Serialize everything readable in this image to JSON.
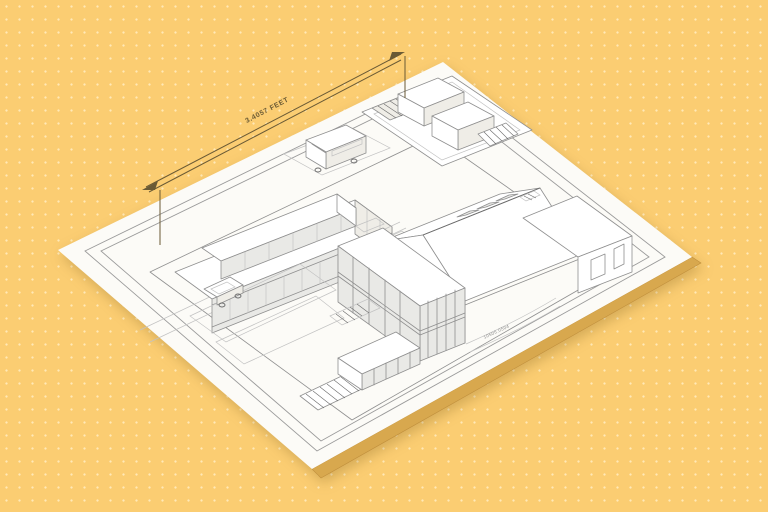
{
  "labels": {
    "dimension_label": "3.4057 FEET",
    "micro_label": "10505.0504"
  },
  "colors": {
    "background": "#FBCD72",
    "background_dot": "#FFE9B8",
    "paper": "#FCFBF7",
    "paper_edge": "#D8A84E",
    "paper_edge_dark": "#C08F3C",
    "frame": "#9A9A9A",
    "line": "#8F8F8F",
    "line_light": "#C2C2C2",
    "line_dark": "#6B6B6B",
    "face_shade": "#EFEDE7",
    "glass": "#E9E9E6",
    "dimension": "#6A5A35",
    "micro": "#8A8A8A"
  }
}
